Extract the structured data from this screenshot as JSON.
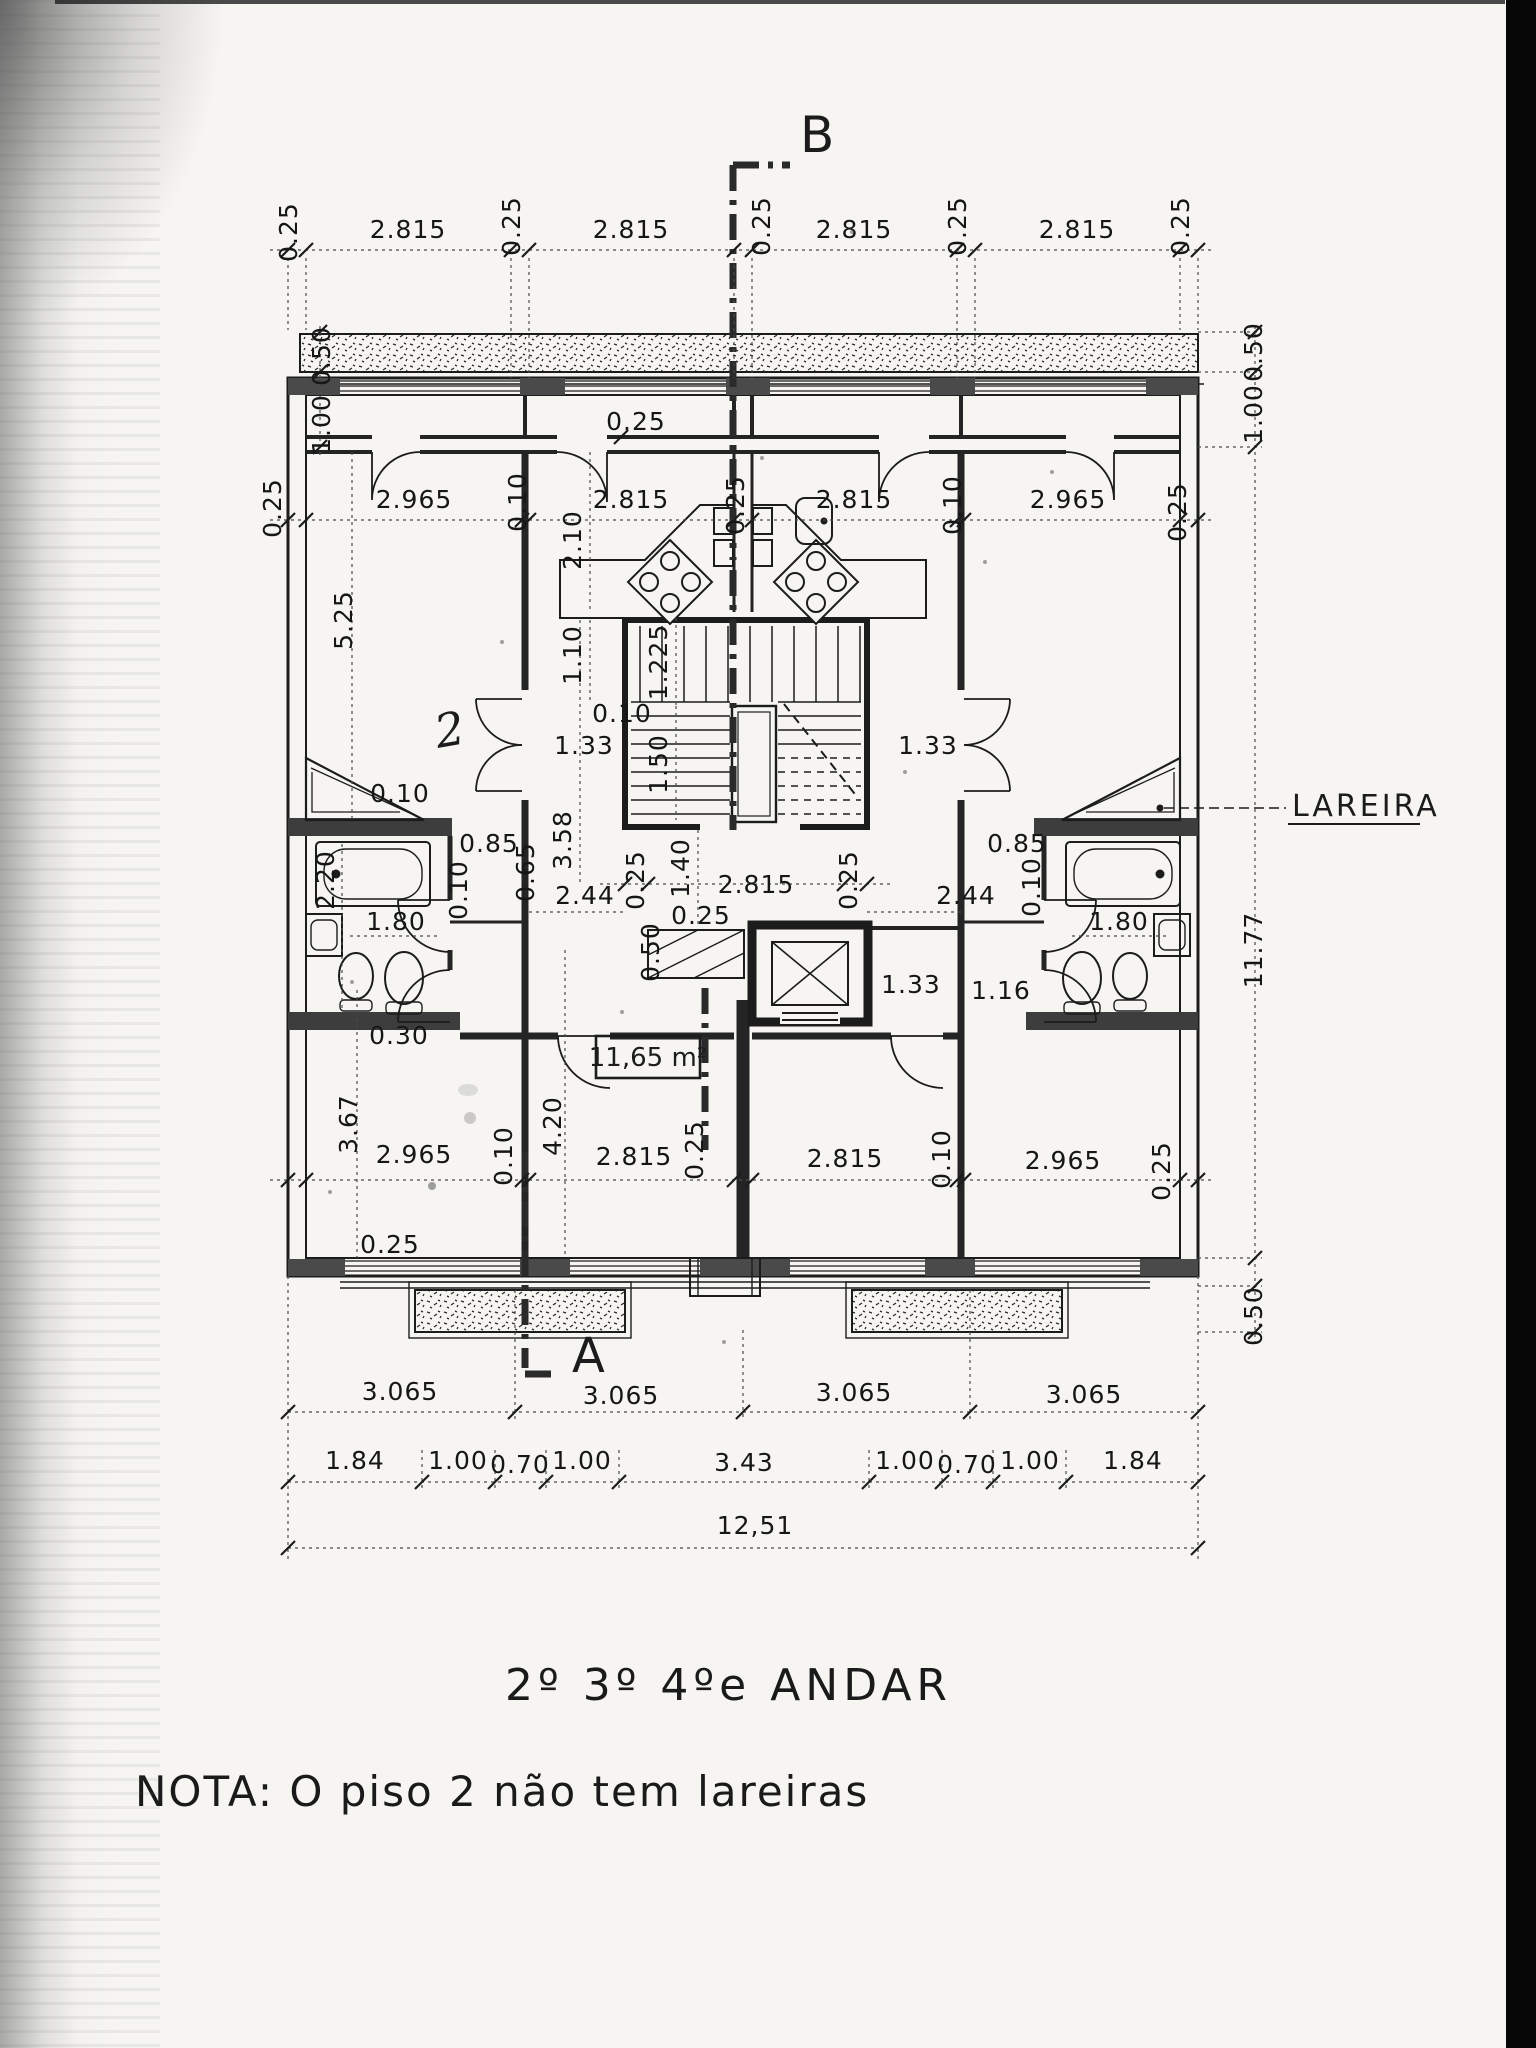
{
  "page": {
    "title": "2º 3º 4ºe ANDAR",
    "note": "NOTA: O piso 2 não tem lareiras"
  },
  "colors": {
    "ink": "#1c1c1c",
    "paper": "#f6f5f2",
    "scan_band": "#070707"
  },
  "section_markers": {
    "top": "B",
    "bottom": "A"
  },
  "annotations": {
    "fireplace": "LAREIRA",
    "room_area": "11,65 m²",
    "handwritten_mark": "2"
  },
  "dimensions": {
    "unit": "m",
    "labels": [
      {
        "t": "0.25",
        "x": 297,
        "y": 232,
        "r": 1
      },
      {
        "t": "2.815",
        "x": 408,
        "y": 238
      },
      {
        "t": "0.25",
        "x": 520,
        "y": 226,
        "r": 1
      },
      {
        "t": "2.815",
        "x": 631,
        "y": 238
      },
      {
        "t": "0.25",
        "x": 770,
        "y": 226,
        "r": 1
      },
      {
        "t": "2.815",
        "x": 854,
        "y": 238
      },
      {
        "t": "0.25",
        "x": 966,
        "y": 226,
        "r": 1
      },
      {
        "t": "2.815",
        "x": 1077,
        "y": 238
      },
      {
        "t": "0.25",
        "x": 1189,
        "y": 226,
        "r": 1
      },
      {
        "t": "0.50",
        "x": 330,
        "y": 356,
        "r": 1
      },
      {
        "t": "1.00",
        "x": 330,
        "y": 424,
        "r": 1
      },
      {
        "t": "0.50",
        "x": 1262,
        "y": 352,
        "r": 1
      },
      {
        "t": "1.00",
        "x": 1262,
        "y": 414,
        "r": 1
      },
      {
        "t": "11.77",
        "x": 1262,
        "y": 950,
        "r": 1
      },
      {
        "t": "0.50",
        "x": 1262,
        "y": 1316,
        "r": 1
      },
      {
        "t": "0.25",
        "x": 281,
        "y": 508,
        "r": 1
      },
      {
        "t": "2.965",
        "x": 414,
        "y": 508
      },
      {
        "t": "0.10",
        "x": 526,
        "y": 502,
        "r": 1
      },
      {
        "t": "2.815",
        "x": 631,
        "y": 508
      },
      {
        "t": "0.25",
        "x": 744,
        "y": 505,
        "r": 1
      },
      {
        "t": "2.815",
        "x": 854,
        "y": 508
      },
      {
        "t": "0.10",
        "x": 961,
        "y": 505,
        "r": 1
      },
      {
        "t": "2.965",
        "x": 1068,
        "y": 508
      },
      {
        "t": "0.25",
        "x": 1186,
        "y": 512,
        "r": 1
      },
      {
        "t": "0.25",
        "x": 636,
        "y": 430
      },
      {
        "t": "2.10",
        "x": 581,
        "y": 540,
        "r": 1
      },
      {
        "t": "1.10",
        "x": 581,
        "y": 655,
        "r": 1
      },
      {
        "t": "1.225",
        "x": 667,
        "y": 662,
        "r": 1
      },
      {
        "t": "0.10",
        "x": 622,
        "y": 722
      },
      {
        "t": "1.33",
        "x": 584,
        "y": 754
      },
      {
        "t": "1.50",
        "x": 667,
        "y": 764,
        "r": 1
      },
      {
        "t": "1.33",
        "x": 928,
        "y": 754
      },
      {
        "t": "3.58",
        "x": 571,
        "y": 840,
        "r": 1
      },
      {
        "t": "1.40",
        "x": 689,
        "y": 868,
        "r": 1
      },
      {
        "t": "0.25",
        "x": 644,
        "y": 880,
        "r": 1
      },
      {
        "t": "2.815",
        "x": 756,
        "y": 893
      },
      {
        "t": "0.25",
        "x": 857,
        "y": 880,
        "r": 1
      },
      {
        "t": "5.25",
        "x": 352,
        "y": 620,
        "r": 1
      },
      {
        "t": "0.10",
        "x": 400,
        "y": 802
      },
      {
        "t": "2.20",
        "x": 334,
        "y": 880,
        "r": 1
      },
      {
        "t": "0.85",
        "x": 489,
        "y": 852
      },
      {
        "t": "0.65",
        "x": 534,
        "y": 872,
        "r": 1
      },
      {
        "t": "0.10",
        "x": 467,
        "y": 890,
        "r": 1
      },
      {
        "t": "2.44",
        "x": 585,
        "y": 904
      },
      {
        "t": "1.80",
        "x": 396,
        "y": 930
      },
      {
        "t": "0.30",
        "x": 399,
        "y": 1044
      },
      {
        "t": "0.85",
        "x": 1017,
        "y": 852
      },
      {
        "t": "0.10",
        "x": 1040,
        "y": 887,
        "r": 1
      },
      {
        "t": "2.44",
        "x": 966,
        "y": 904
      },
      {
        "t": "1.80",
        "x": 1119,
        "y": 930
      },
      {
        "t": "1.16",
        "x": 1001,
        "y": 999
      },
      {
        "t": "1.33",
        "x": 911,
        "y": 993
      },
      {
        "t": "0.25",
        "x": 701,
        "y": 924
      },
      {
        "t": "0.50",
        "x": 659,
        "y": 952,
        "r": 1
      },
      {
        "t": "3.67",
        "x": 357,
        "y": 1124,
        "r": 1
      },
      {
        "t": "2.965",
        "x": 414,
        "y": 1163
      },
      {
        "t": "0.10",
        "x": 512,
        "y": 1156,
        "r": 1
      },
      {
        "t": "4.20",
        "x": 561,
        "y": 1126,
        "r": 1
      },
      {
        "t": "2.815",
        "x": 634,
        "y": 1165
      },
      {
        "t": "0.25",
        "x": 703,
        "y": 1150,
        "r": 1
      },
      {
        "t": "2.815",
        "x": 845,
        "y": 1167
      },
      {
        "t": "0.10",
        "x": 950,
        "y": 1159,
        "r": 1
      },
      {
        "t": "2.965",
        "x": 1063,
        "y": 1169
      },
      {
        "t": "0.25",
        "x": 1170,
        "y": 1171,
        "r": 1
      },
      {
        "t": "0.25",
        "x": 390,
        "y": 1253
      },
      {
        "t": "3.065",
        "x": 400,
        "y": 1400
      },
      {
        "t": "3.065",
        "x": 621,
        "y": 1404
      },
      {
        "t": "3.065",
        "x": 854,
        "y": 1401
      },
      {
        "t": "3.065",
        "x": 1084,
        "y": 1403
      },
      {
        "t": "1.84",
        "x": 355,
        "y": 1469
      },
      {
        "t": "1.00",
        "x": 458,
        "y": 1469
      },
      {
        "t": "0.70",
        "x": 520,
        "y": 1473
      },
      {
        "t": "1.00",
        "x": 582,
        "y": 1469
      },
      {
        "t": "3.43",
        "x": 744,
        "y": 1471
      },
      {
        "t": "1.00",
        "x": 905,
        "y": 1469
      },
      {
        "t": "0.70",
        "x": 967,
        "y": 1473
      },
      {
        "t": "1.00",
        "x": 1030,
        "y": 1469
      },
      {
        "t": "1.84",
        "x": 1133,
        "y": 1469
      },
      {
        "t": "12,51",
        "x": 755,
        "y": 1534
      }
    ]
  }
}
